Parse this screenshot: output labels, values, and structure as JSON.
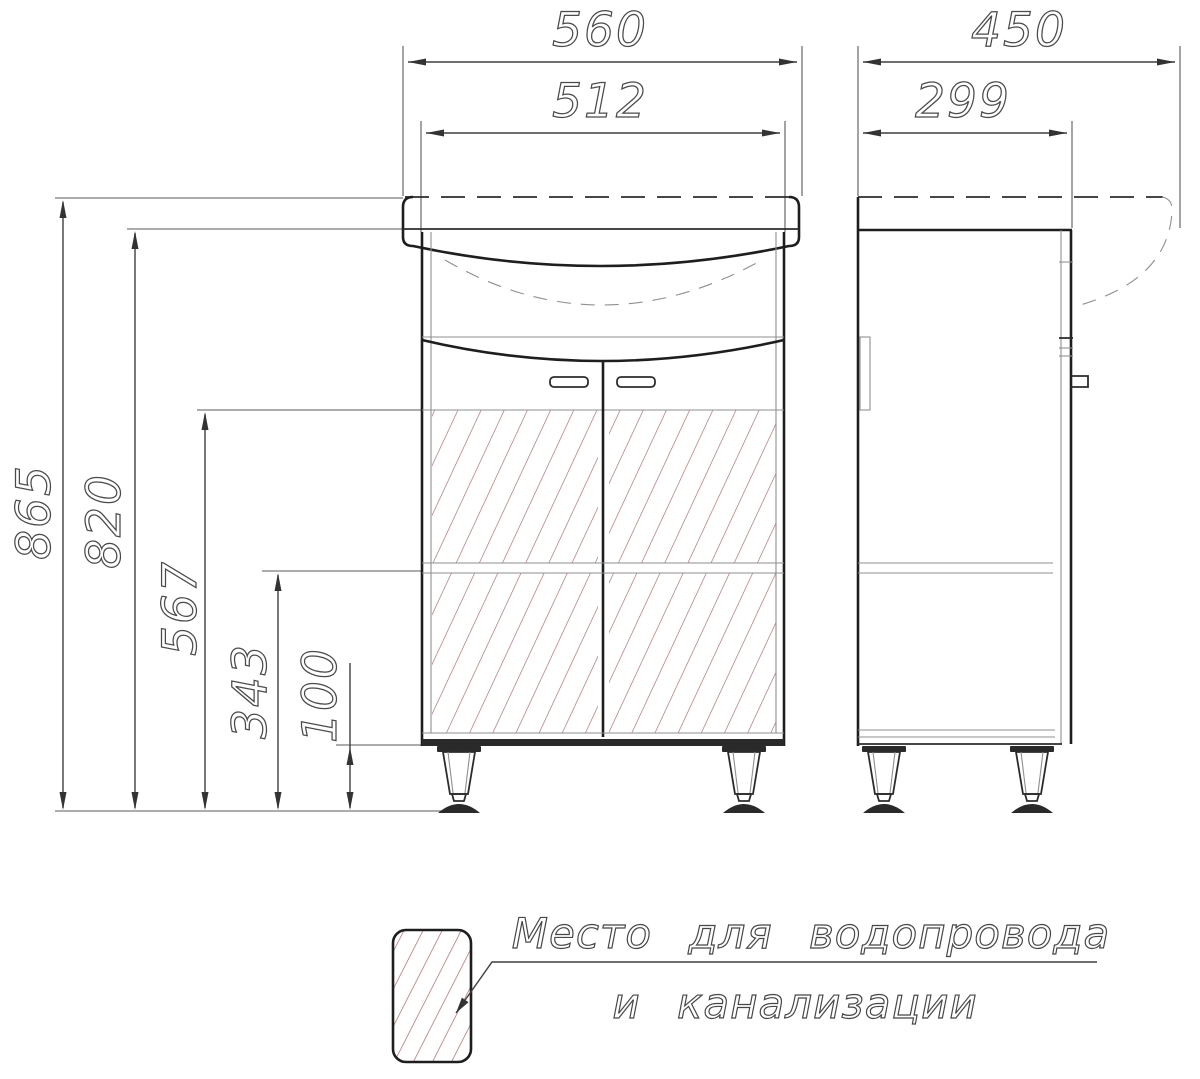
{
  "dims": {
    "sink_width": "560",
    "cabinet_width": "512",
    "sink_depth": "450",
    "cabinet_depth": "299",
    "total_height": "865",
    "cabinet_height": "820",
    "service_zone_height": "567",
    "shelf_height": "343",
    "leg_height": "100"
  },
  "legend": {
    "label_line1": "Место для водопровода",
    "label_line2": "и канализации"
  },
  "colors": {
    "line": "#1e1e1e",
    "dim_text": "#4a4a4a",
    "hatch": "#a56969",
    "background": "#ffffff"
  }
}
